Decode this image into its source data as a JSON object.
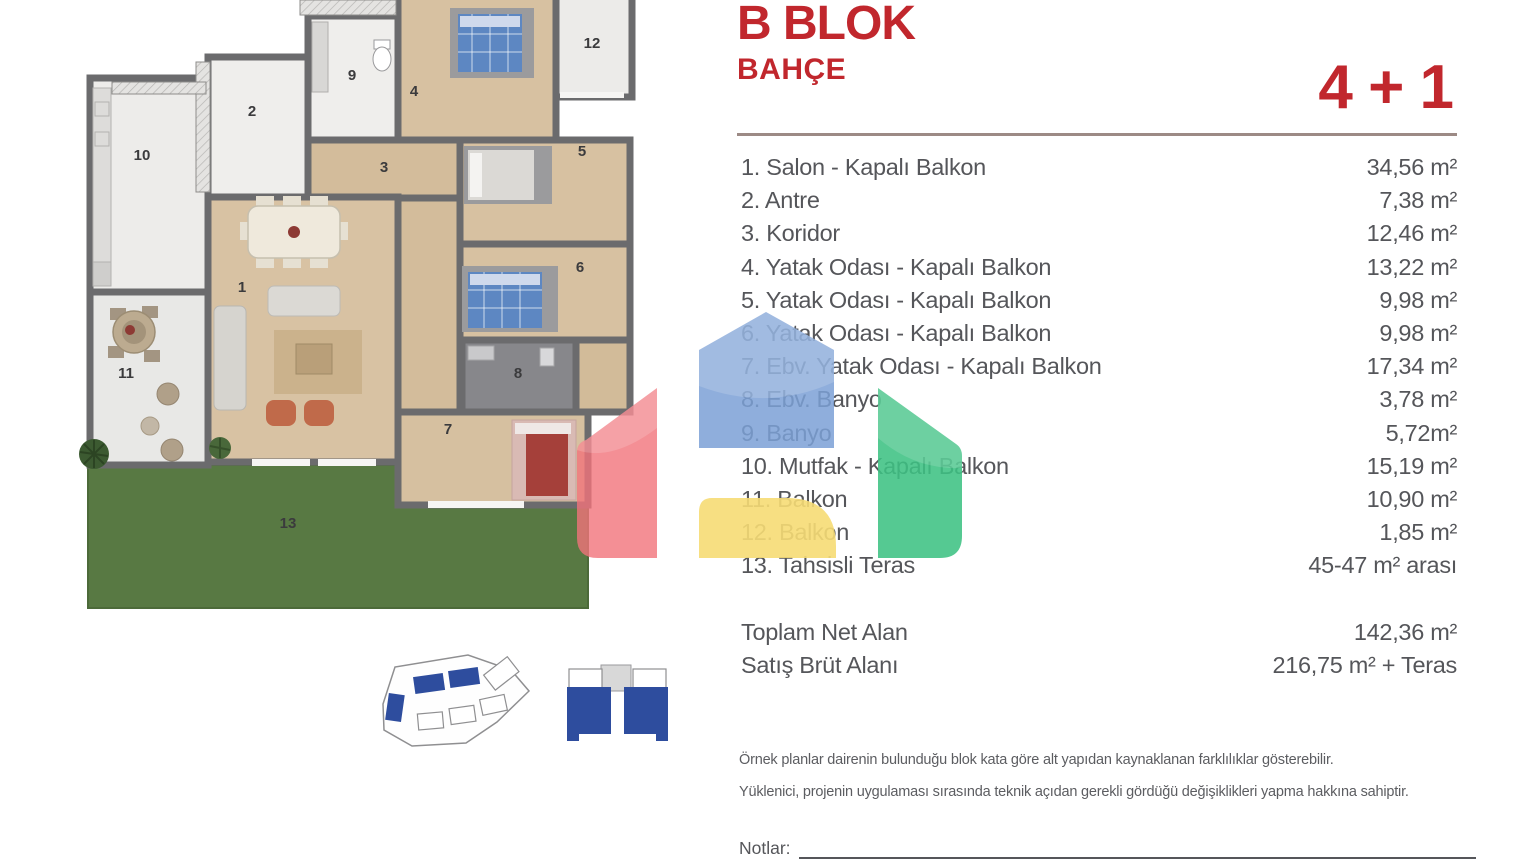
{
  "header": {
    "block_title": "B BLOK",
    "subtitle": "BAHÇE",
    "unit_type": "4 + 1"
  },
  "rooms": [
    {
      "label": "1. Salon - Kapalı Balkon",
      "area": "34,56 m²"
    },
    {
      "label": "2. Antre",
      "area": "7,38 m²"
    },
    {
      "label": "3. Koridor",
      "area": "12,46 m²"
    },
    {
      "label": "4. Yatak Odası - Kapalı Balkon",
      "area": "13,22 m²"
    },
    {
      "label": "5. Yatak Odası - Kapalı Balkon",
      "area": "9,98 m²"
    },
    {
      "label": "6. Yatak Odası - Kapalı Balkon",
      "area": "9,98 m²"
    },
    {
      "label": "7. Ebv. Yatak Odası - Kapalı Balkon",
      "area": "17,34 m²"
    },
    {
      "label": "8. Ebv. Banyo",
      "area": "3,78 m²"
    },
    {
      "label": "9. Banyo",
      "area": "5,72m²"
    },
    {
      "label": "10. Mutfak - Kapalı Balkon",
      "area": "15,19 m²"
    },
    {
      "label": "11. Balkon",
      "area": "10,90 m²"
    },
    {
      "label": "12. Balkon",
      "area": "1,85 m²"
    },
    {
      "label": "13. Tahsisli Teras",
      "area": "45-47 m² arası"
    }
  ],
  "totals": [
    {
      "label": "Toplam Net Alan",
      "value": "142,36 m²"
    },
    {
      "label": "Satış Brüt Alanı",
      "value": "216,75 m² + Teras"
    }
  ],
  "disclaimers": [
    "Örnek planlar dairenin bulunduğu blok kata göre alt yapıdan kaynaklanan farklılıklar gösterebilir.",
    "Yüklenici, projenin uygulaması sırasında teknik açıdan gerekli gördüğü değişiklikleri yapma hakkına sahiptir."
  ],
  "notes": {
    "label": "Notlar:"
  },
  "floorplan": {
    "room_labels": [
      {
        "n": "1",
        "x": 242,
        "y": 292
      },
      {
        "n": "2",
        "x": 252,
        "y": 116
      },
      {
        "n": "3",
        "x": 384,
        "y": 172
      },
      {
        "n": "4",
        "x": 414,
        "y": 96
      },
      {
        "n": "5",
        "x": 582,
        "y": 156
      },
      {
        "n": "6",
        "x": 580,
        "y": 272
      },
      {
        "n": "7",
        "x": 448,
        "y": 434
      },
      {
        "n": "8",
        "x": 518,
        "y": 378
      },
      {
        "n": "9",
        "x": 352,
        "y": 80
      },
      {
        "n": "10",
        "x": 142,
        "y": 160
      },
      {
        "n": "11",
        "x": 126,
        "y": 378
      },
      {
        "n": "12",
        "x": 592,
        "y": 48
      },
      {
        "n": "13",
        "x": 288,
        "y": 528
      }
    ]
  },
  "colors": {
    "accent_red": "#c1272d",
    "text_gray": "#55565a",
    "divider": "#9c8a85",
    "wall_gray": "#6b6b6d",
    "wood_floor": "#d8c2a3",
    "tile_floor": "#eeedeb",
    "bath_gray": "#87878b",
    "grass_green": "#587943",
    "bed_blue": "#5d87c2",
    "keyplan_blue": "#2e4d9e",
    "logo_red": "#f1737a",
    "logo_blue": "#7ba0d6",
    "logo_green": "#3ec183",
    "logo_yellow": "#f6dc74"
  }
}
